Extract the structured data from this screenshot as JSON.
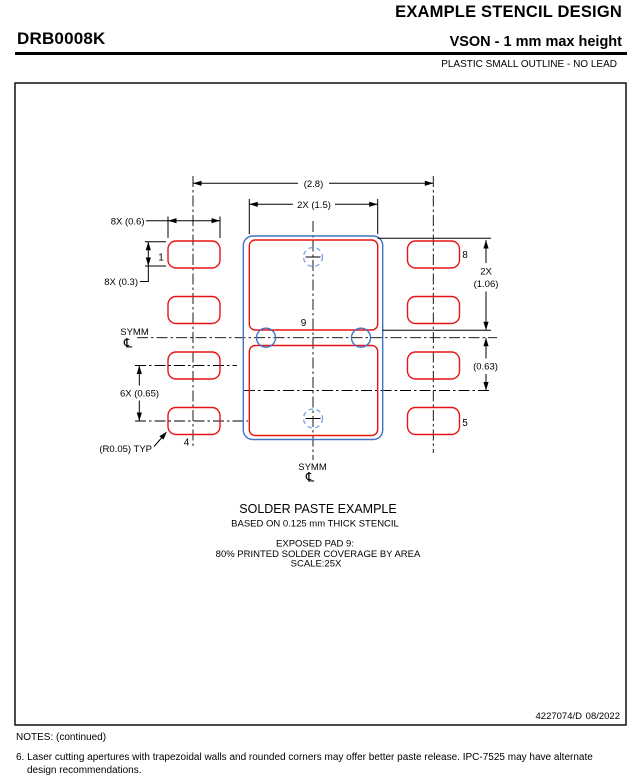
{
  "header": {
    "title": "EXAMPLE STENCIL DESIGN",
    "part_number": "DRB0008K",
    "subtitle": "VSON - 1 mm max height",
    "package_type": "PLASTIC SMALL OUTLINE - NO LEAD"
  },
  "drawing": {
    "symm": "SYMM",
    "centerline_symbol": "℄",
    "pins": {
      "p1": "1",
      "p4": "4",
      "p5": "5",
      "p8": "8",
      "p9": "9"
    },
    "dims": {
      "overall": "(2.8)",
      "paste_w": "2X (1.5)",
      "pad_w": "8X (0.6)",
      "pad_h": "8X (0.3)",
      "pitch": "6X (0.65)",
      "paste_h1": "2X",
      "paste_h2": "(1.06)",
      "offset": "(0.63)",
      "radius": "(R0.05) TYP"
    },
    "colors": {
      "aperture_red": "#e81313",
      "outline_blue": "#4472c4",
      "dashed_blue": "#7aa2e8"
    }
  },
  "caption": {
    "line1": "SOLDER PASTE EXAMPLE",
    "line2": "BASED ON 0.125 mm THICK STENCIL",
    "line3": "EXPOSED PAD 9:",
    "line4": "80% PRINTED SOLDER COVERAGE BY AREA",
    "line5": "SCALE:25X"
  },
  "stamp": {
    "number": "4227074/D",
    "date": "08/2022"
  },
  "notes": {
    "heading": "NOTES: (continued)",
    "note6_number": "6.",
    "note6_text": " Laser cutting apertures with trapezoidal walls and rounded corners may offer better paste release. IPC-7525 may have alternate design recommendations."
  }
}
